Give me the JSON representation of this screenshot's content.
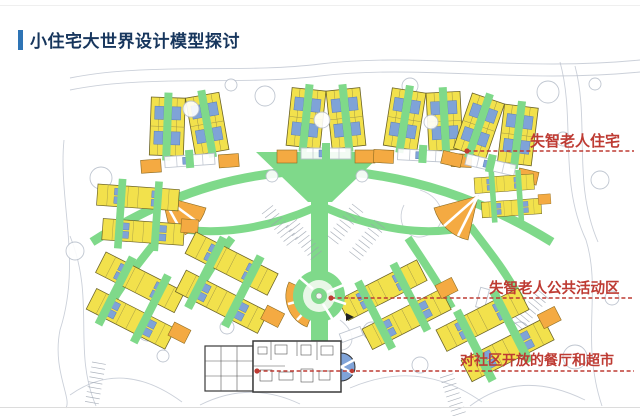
{
  "slide": {
    "title": "小住宅大世界设计模型探讨"
  },
  "annotations": {
    "housing_label": "失智老人住宅",
    "activity_label": "失智老人公共活动区",
    "dining_label": "对社区开放的餐厅和超市"
  },
  "colors": {
    "title-text": "#17365D",
    "title-bar": "#2E74B5",
    "annotation-red": "#BE3B33",
    "path-green": "#7FD98A",
    "building-yellow": "#F2E14C",
    "unit-blue": "#7FA3D8",
    "hub-orange": "#F4AA42",
    "context-gray": "#B9C0CC"
  }
}
